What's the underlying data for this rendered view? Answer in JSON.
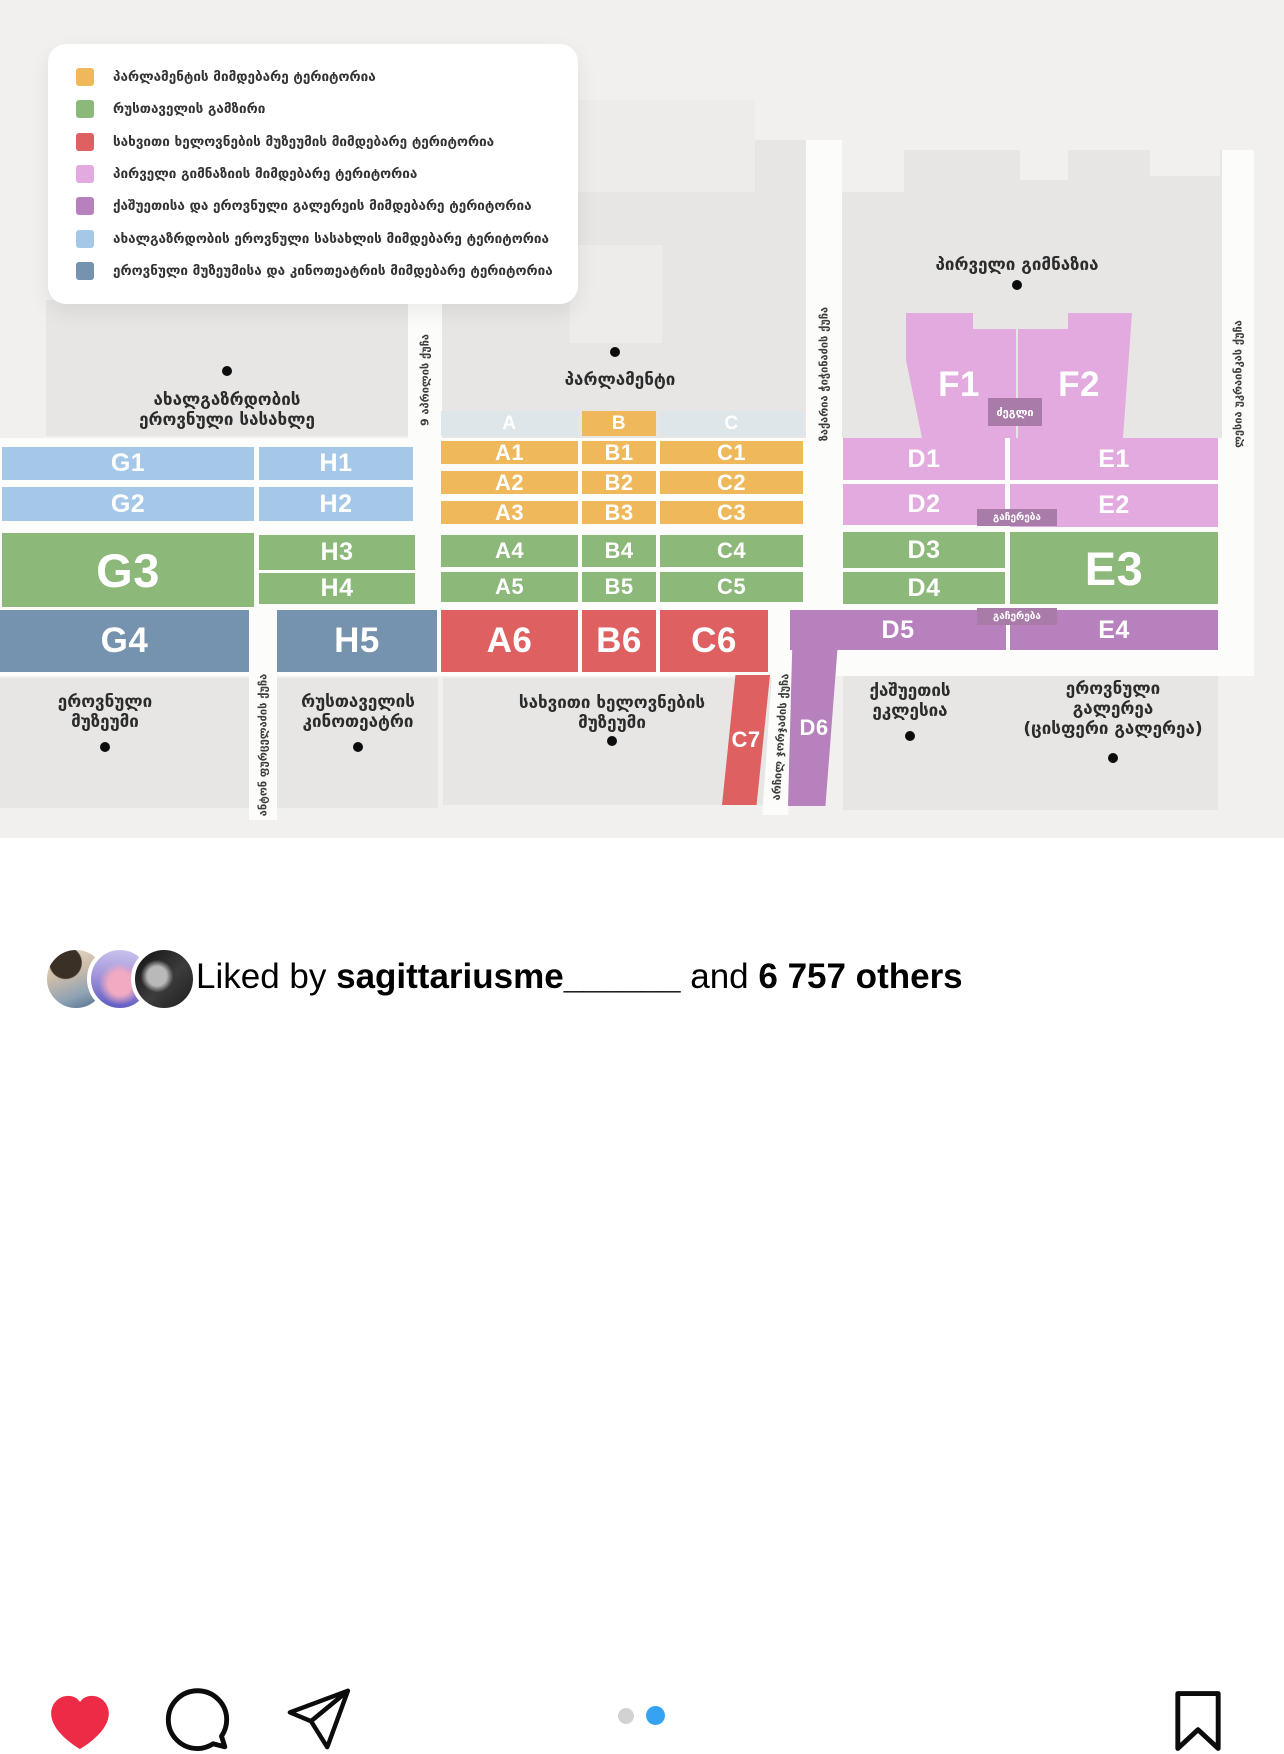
{
  "colors": {
    "orange": "#efb85b",
    "green": "#8cb87a",
    "red": "#df6060",
    "pink": "#e2aade",
    "purple": "#b781bd",
    "lightblue": "#a6c8e8",
    "steelblue": "#7592ae",
    "pagination_blue": "#35a3f2",
    "heart_red": "#ee2b47"
  },
  "legend": {
    "items": [
      {
        "key": "orange",
        "label": "პარლამენტის მიმდებარე ტერიტორია"
      },
      {
        "key": "green",
        "label": "რუსთაველის გამზირი"
      },
      {
        "key": "red",
        "label": "სახვითი ხელოვნების მუზეუმის მიმდებარე ტერიტორია"
      },
      {
        "key": "pink",
        "label": "პირველი გიმნაზიის მიმდებარე ტერიტორია"
      },
      {
        "key": "purple",
        "label": "ქაშუეთისა და ეროვნული გალერეის მიმდებარე ტერიტორია"
      },
      {
        "key": "lightblue",
        "label": "ახალგაზრდობის ეროვნული სასახლის მიმდებარე ტერიტორია"
      },
      {
        "key": "steelblue",
        "label": "ეროვნული მუზეუმისა და კინოთეატრის მიმდებარე ტერიტორია"
      }
    ]
  },
  "map": {
    "labels": {
      "youth_palace": [
        "ახალგაზრდობის",
        "ეროვნული სასახლე"
      ],
      "parliament": "პარლამენტი",
      "gymnasium": "პირველი გიმნაზია",
      "national_museum": [
        "ეროვნული",
        "მუზეუმი"
      ],
      "cinema": [
        "რუსთაველის",
        "კინოთეატრი"
      ],
      "fine_arts_museum": [
        "სახვითი ხელოვნების",
        "მუზეუმი"
      ],
      "kashueti_church": [
        "ქაშუეთის",
        "ეკლესია"
      ],
      "national_gallery": [
        "ეროვნული",
        "გალერეა",
        "(ცისფერი გალერეა)"
      ]
    },
    "streets": {
      "april9": "9 აპრილის ქუჩა",
      "chichinadze": "ზაქარია ჭიჭინაძის ქუჩა",
      "ukrainka": "ლესია უკრაინკას ქუჩა",
      "purtseladze": "ანტონ ფურცელაძის ქუჩა",
      "jorjadze": "არჩილ ჯორჯაძის ქუჩა"
    },
    "markers": {
      "monument": "ძეგლი",
      "stop1": "გაჩერება",
      "stop2": "გაჩერება"
    },
    "zones": {
      "headerA": "A",
      "headerB": "B",
      "headerC": "C",
      "A1": "A1",
      "A2": "A2",
      "A3": "A3",
      "A4": "A4",
      "A5": "A5",
      "A6": "A6",
      "B1": "B1",
      "B2": "B2",
      "B3": "B3",
      "B4": "B4",
      "B5": "B5",
      "B6": "B6",
      "C1": "C1",
      "C2": "C2",
      "C3": "C3",
      "C4": "C4",
      "C5": "C5",
      "C6": "C6",
      "C7": "C7",
      "D1": "D1",
      "D2": "D2",
      "D3": "D3",
      "D4": "D4",
      "D5": "D5",
      "D6": "D6",
      "E1": "E1",
      "E2": "E2",
      "E3": "E3",
      "E4": "E4",
      "F1": "F1",
      "F2": "F2",
      "G1": "G1",
      "G2": "G2",
      "G3": "G3",
      "G4": "G4",
      "H1": "H1",
      "H2": "H2",
      "H3": "H3",
      "H4": "H4",
      "H5": "H5"
    }
  },
  "post": {
    "pagination": {
      "total": 2,
      "active_index": 1
    },
    "liked_by": {
      "prefix": "Liked by",
      "username": "sagittariusme______",
      "connector": "and",
      "others": "6 757 others"
    }
  }
}
